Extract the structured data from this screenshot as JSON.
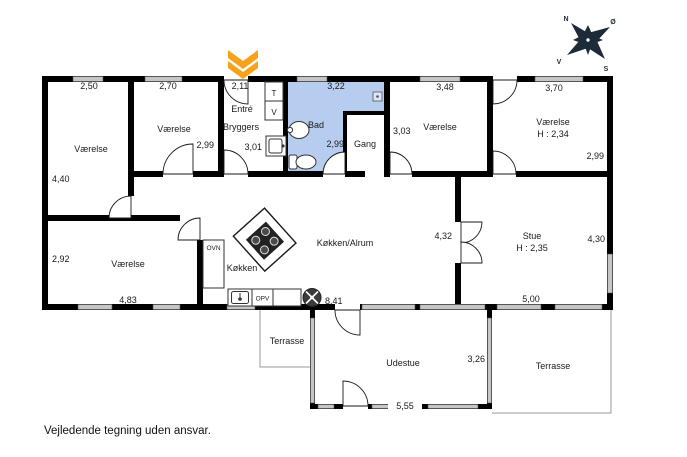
{
  "note": {
    "disclaimer": "Vejledende tegning uden ansvar."
  },
  "compass": {
    "north": "N",
    "east": "Ø",
    "south": "S",
    "west": "V"
  },
  "colors": {
    "wall": "#000000",
    "window_fill": "#c6c6c6",
    "bad_room_fill": "#b7cdf0",
    "entrance_arrow": "#f6a21b",
    "compass_fill": "#1d2b38",
    "thin_line": "#999999"
  },
  "icons": {
    "entrance": "entrance-chevron-down-icon",
    "compass": "compass-rose-icon",
    "sink": "sink-icon",
    "toilet": "toilet-icon",
    "stove": "stove-island-icon",
    "hob": "hob-fan-icon",
    "drain": "floor-drain-icon"
  },
  "rooms": {
    "vaerelse_nw": {
      "label": "Værelse"
    },
    "vaerelse_n": {
      "label": "Værelse"
    },
    "entre": {
      "label": "Entré"
    },
    "bryggers": {
      "label": "Bryggers"
    },
    "bad": {
      "label": "Bad"
    },
    "gang": {
      "label": "Gang"
    },
    "vaerelse_mid": {
      "label": "Værelse"
    },
    "vaerelse_ne": {
      "label": "Værelse",
      "ceiling": "H : 2,34"
    },
    "koekken_alrum": {
      "label": "Køkken/Alrum"
    },
    "koekken": {
      "label": "Køkken"
    },
    "stue": {
      "label": "Stue",
      "ceiling": "H : 2,35"
    },
    "vaerelse_sw": {
      "label": "Værelse"
    },
    "terrasse_small": {
      "label": "Terrasse"
    },
    "udestue": {
      "label": "Udestue"
    },
    "terrasse_large": {
      "label": "Terrasse"
    }
  },
  "dimensions": {
    "room_nw_w": "2,50",
    "room_nw_h": "4,40",
    "room_n_w": "2,70",
    "room_n_h": "2,99",
    "entre_w": "2,11",
    "bryggers_h": "3,01",
    "bad_w": "3,22",
    "bad_h": "2,99",
    "gang_h": "3,03",
    "room_mid_w": "3,48",
    "room_ne_w": "3,70",
    "room_ne_h": "2,99",
    "room_sw_h": "2,92",
    "room_sw_w": "4,83",
    "alrum_h": "4,32",
    "alrum_w": "8,41",
    "stue_h": "4,30",
    "stue_w": "5,00",
    "udestue_w": "5,55",
    "udestue_h": "3,26"
  },
  "appliances": {
    "dryer": "T",
    "washer": "V",
    "oven": "OVN",
    "dishwasher": "OPV"
  }
}
